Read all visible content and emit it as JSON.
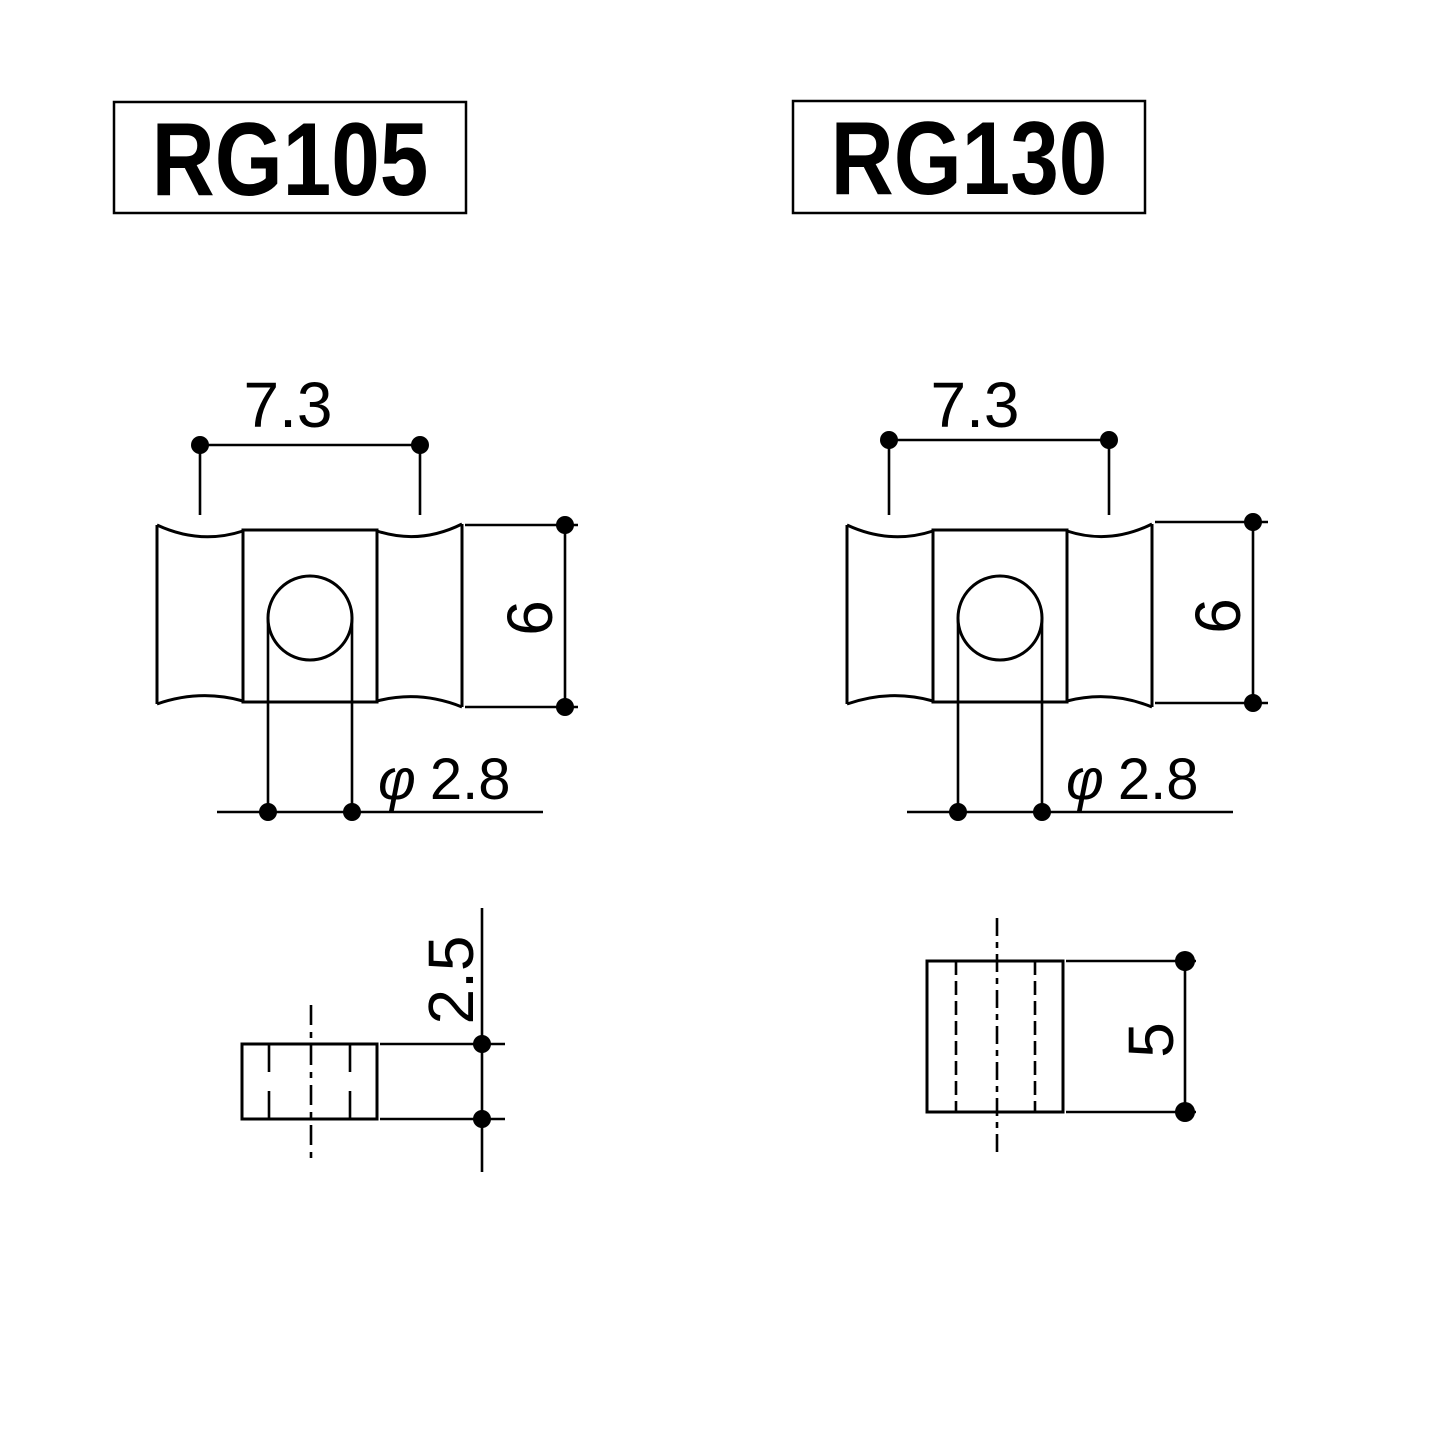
{
  "document": {
    "background": "#ffffff",
    "ink": "#000000",
    "type": "technical-dimension-drawing"
  },
  "parts": [
    {
      "model": "RG105",
      "top_view": {
        "width": "7.3",
        "height": "6",
        "hole_symbol": "φ",
        "hole_diameter": "2.8"
      },
      "side_view": {
        "thickness": "2.5"
      }
    },
    {
      "model": "RG130",
      "top_view": {
        "width": "7.3",
        "height": "6",
        "hole_symbol": "φ",
        "hole_diameter": "2.8"
      },
      "side_view": {
        "thickness": "5"
      }
    }
  ]
}
